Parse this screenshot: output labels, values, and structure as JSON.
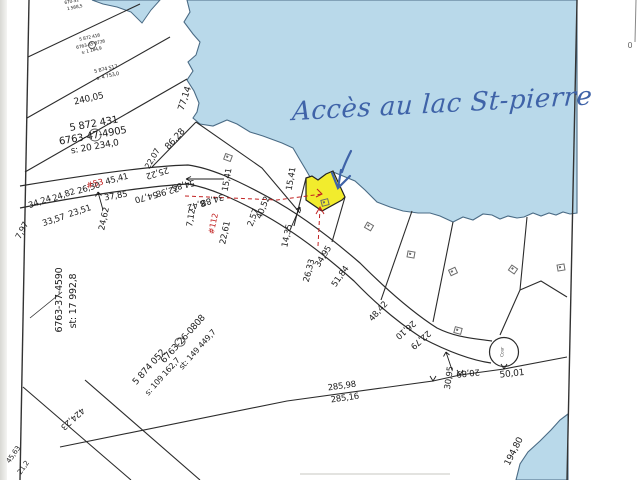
{
  "annotation": {
    "text": "Accès au lac St-pierre",
    "ink_color": "#3f63a8"
  },
  "colors": {
    "water": "#b9d9ea",
    "water_edge": "#4a6b85",
    "highlight_lot": "#f2ec2d",
    "line": "#2b2b2b",
    "red_label": "#c22222"
  },
  "map": {
    "labels": [
      {
        "t": "670-52",
        "x": 72,
        "y": 3,
        "r": -12,
        "s": 4.5
      },
      {
        "t": "1 568,5",
        "x": 75,
        "y": 9,
        "r": -12,
        "s": 4.5
      },
      {
        "t": "5 872 416",
        "x": 90,
        "y": 39,
        "r": -13,
        "s": 4.5
      },
      {
        "t": "6763-45-8726",
        "x": 91,
        "y": 46,
        "r": -13,
        "s": 4.5
      },
      {
        "t": "s: 1 184,9",
        "x": 92,
        "y": 52,
        "r": -13,
        "s": 4.5
      },
      {
        "t": "5 874 517",
        "x": 106,
        "y": 70,
        "r": -13,
        "s": 5
      },
      {
        "t": "s: 4 753,0",
        "x": 108,
        "y": 77,
        "r": -13,
        "s": 5
      },
      {
        "t": "240,05",
        "x": 89,
        "y": 100,
        "r": -13,
        "s": 9
      },
      {
        "t": "77,14",
        "x": 186,
        "y": 99,
        "r": -72,
        "s": 9
      },
      {
        "t": "5 872 431",
        "x": 94,
        "y": 125,
        "r": -10,
        "s": 10
      },
      {
        "t": "6763-47-4905",
        "x": 93,
        "y": 137,
        "r": -10,
        "s": 10
      },
      {
        "t": "s: 20 234,0",
        "x": 95,
        "y": 148,
        "r": -10,
        "s": 9
      },
      {
        "t": "86,28",
        "x": 176,
        "y": 140,
        "r": -48,
        "s": 9
      },
      {
        "t": "22,07",
        "x": 153,
        "y": 159,
        "r": -60,
        "s": 8
      },
      {
        "t": "34,24",
        "x": 40,
        "y": 203,
        "r": -19,
        "s": 8.5
      },
      {
        "t": "24,82",
        "x": 64,
        "y": 196,
        "r": -19,
        "s": 8.5
      },
      {
        "t": "26,30",
        "x": 89,
        "y": 189,
        "r": -17,
        "s": 8.5
      },
      {
        "t": "45,41",
        "x": 117,
        "y": 180,
        "r": -15,
        "s": 8.5
      },
      {
        "t": "25,22",
        "x": 157,
        "y": 172,
        "r": 163,
        "s": 8.5
      },
      {
        "t": "54,85",
        "x": 183,
        "y": 184,
        "r": 167,
        "s": 8.5
      },
      {
        "t": "54,70",
        "x": 146,
        "y": 196,
        "r": 165,
        "s": 8.5
      },
      {
        "t": "22,98",
        "x": 167,
        "y": 190,
        "r": 165,
        "s": 8.5
      },
      {
        "t": "#53",
        "x": 95,
        "y": 185,
        "r": -14,
        "s": 8.5,
        "c": "#c22222"
      },
      {
        "t": "37,85",
        "x": 116,
        "y": 197,
        "r": -10,
        "s": 8.5
      },
      {
        "t": "33,57",
        "x": 54,
        "y": 221,
        "r": -18,
        "s": 8.5
      },
      {
        "t": "23,51",
        "x": 80,
        "y": 212,
        "r": -18,
        "s": 8.5
      },
      {
        "t": "7,97",
        "x": 23,
        "y": 231,
        "r": -62,
        "s": 8.5
      },
      {
        "t": "24,62",
        "x": 105,
        "y": 219,
        "r": -78,
        "s": 8.5
      },
      {
        "t": "8,42",
        "x": 196,
        "y": 204,
        "r": 163,
        "s": 8.5
      },
      {
        "t": "34,88",
        "x": 212,
        "y": 199,
        "r": 163,
        "s": 8.5
      },
      {
        "t": "7,12",
        "x": 192,
        "y": 218,
        "r": -80,
        "s": 8.5
      },
      {
        "t": "2,57",
        "x": 254,
        "y": 218,
        "r": -70,
        "s": 8.5
      },
      {
        "t": "40,52",
        "x": 264,
        "y": 208,
        "r": -68,
        "s": 8.5
      },
      {
        "t": "22,61",
        "x": 226,
        "y": 233,
        "r": -78,
        "s": 8.5
      },
      {
        "t": "#112",
        "x": 214,
        "y": 224,
        "r": -78,
        "s": 8,
        "c": "#c22222"
      },
      {
        "t": "15,41",
        "x": 228,
        "y": 180,
        "r": -80,
        "s": 8.5
      },
      {
        "t": "15,41",
        "x": 292,
        "y": 179,
        "r": -80,
        "s": 8.5
      },
      {
        "t": "14,35",
        "x": 288,
        "y": 236,
        "r": -78,
        "s": 8.5
      },
      {
        "t": "26,33",
        "x": 310,
        "y": 271,
        "r": -75,
        "s": 8.5
      },
      {
        "t": "34,95",
        "x": 324,
        "y": 257,
        "r": -58,
        "s": 8.5
      },
      {
        "t": "51,84",
        "x": 341,
        "y": 277,
        "r": -55,
        "s": 8.5
      },
      {
        "t": "48,42",
        "x": 379,
        "y": 312,
        "r": -48,
        "s": 8.5
      },
      {
        "t": "26,10",
        "x": 405,
        "y": 329,
        "r": 139,
        "s": 8.5
      },
      {
        "t": "22,79",
        "x": 420,
        "y": 339,
        "r": 139,
        "s": 8.5
      },
      {
        "t": "30,95",
        "x": 450,
        "y": 378,
        "r": -82,
        "s": 8.5
      },
      {
        "t": "20,89",
        "x": 468,
        "y": 372,
        "r": 174,
        "s": 8.5
      },
      {
        "t": "50,01",
        "x": 512,
        "y": 375,
        "r": -6,
        "s": 9
      },
      {
        "t": "285,98",
        "x": 342,
        "y": 387,
        "r": -8,
        "s": 8.5
      },
      {
        "t": "285,16",
        "x": 345,
        "y": 399,
        "r": -8,
        "s": 8.5
      },
      {
        "t": "5 874 052",
        "x": 150,
        "y": 368,
        "r": -48,
        "s": 9
      },
      {
        "t": "s: 109 162,7",
        "x": 163,
        "y": 377,
        "r": -48,
        "s": 8
      },
      {
        "t": "6763-26-0808",
        "x": 184,
        "y": 340,
        "r": -48,
        "s": 9
      },
      {
        "t": "st: 149 449,7",
        "x": 198,
        "y": 350,
        "r": -48,
        "s": 8
      },
      {
        "t": "6763-37-4590",
        "x": 60,
        "y": 300,
        "r": -90,
        "s": 9.5
      },
      {
        "t": "st: 17 992,8",
        "x": 74,
        "y": 301,
        "r": -90,
        "s": 9.5
      },
      {
        "t": "424,23",
        "x": 72,
        "y": 418,
        "r": 138,
        "s": 8.5
      },
      {
        "t": "45,63",
        "x": 14,
        "y": 455,
        "r": -55,
        "s": 7
      },
      {
        "t": "21,2",
        "x": 24,
        "y": 468,
        "r": -55,
        "s": 7
      },
      {
        "t": "194,80",
        "x": 515,
        "y": 452,
        "r": -63,
        "s": 9
      },
      {
        "t": "Cour",
        "x": 504,
        "y": 352,
        "r": -90,
        "s": 4.5,
        "c": "#555555"
      },
      {
        "t": "0",
        "x": 630,
        "y": 46,
        "r": 0,
        "s": 8,
        "c": "#666666"
      }
    ],
    "markers": [
      {
        "x": 227,
        "y": 157,
        "r": 20
      },
      {
        "x": 324,
        "y": 202,
        "r": -15
      },
      {
        "x": 368,
        "y": 226,
        "r": 30
      },
      {
        "x": 410,
        "y": 254,
        "r": 10
      },
      {
        "x": 452,
        "y": 271,
        "r": -25
      },
      {
        "x": 457,
        "y": 330,
        "r": 15
      },
      {
        "x": 512,
        "y": 269,
        "r": 35
      },
      {
        "x": 560,
        "y": 267,
        "r": -10
      }
    ]
  }
}
